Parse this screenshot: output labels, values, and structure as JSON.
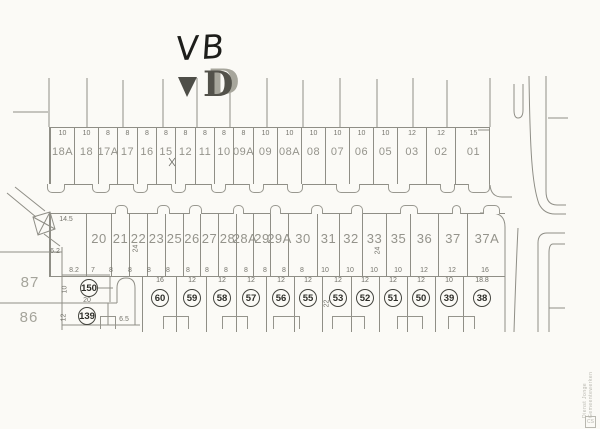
{
  "annotations": {
    "handwritten_label": "VB",
    "printed_fragment_letter": "D",
    "correction_mark_between_15_12": "x"
  },
  "watermark": {
    "text": "Dienst Jonge Gemeentewerken",
    "logo": "CS"
  },
  "north_row": {
    "box": {
      "x": 49,
      "y": 127,
      "w": 441,
      "h": 58
    },
    "lots": [
      {
        "num": "18A",
        "dim": "10",
        "x": 0,
        "w": 24
      },
      {
        "num": "18",
        "dim": "10",
        "x": 24,
        "w": 24
      },
      {
        "num": "17A",
        "dim": "8",
        "x": 48,
        "w": 19
      },
      {
        "num": "17",
        "dim": "8",
        "x": 67,
        "w": 20
      },
      {
        "num": "16",
        "dim": "8",
        "x": 87,
        "w": 19
      },
      {
        "num": "15",
        "dim": "8",
        "x": 106,
        "w": 19
      },
      {
        "num": "12",
        "dim": "8",
        "x": 125,
        "w": 20
      },
      {
        "num": "11",
        "dim": "8",
        "x": 145,
        "w": 19
      },
      {
        "num": "10",
        "dim": "8",
        "x": 164,
        "w": 19
      },
      {
        "num": "09A",
        "dim": "8",
        "x": 183,
        "w": 20
      },
      {
        "num": "09",
        "dim": "10",
        "x": 203,
        "w": 24
      },
      {
        "num": "08A",
        "dim": "10",
        "x": 227,
        "w": 24
      },
      {
        "num": "08",
        "dim": "10",
        "x": 251,
        "w": 24
      },
      {
        "num": "07",
        "dim": "10",
        "x": 275,
        "w": 24
      },
      {
        "num": "06",
        "dim": "10",
        "x": 299,
        "w": 24
      },
      {
        "num": "05",
        "dim": "10",
        "x": 323,
        "w": 24
      },
      {
        "num": "03",
        "dim": "12",
        "x": 347,
        "w": 29
      },
      {
        "num": "02",
        "dim": "12",
        "x": 376,
        "w": 29
      },
      {
        "num": "01",
        "dim": "15",
        "x": 405,
        "w": 36
      }
    ]
  },
  "middle_row": {
    "box": {
      "x": 49,
      "y": 213,
      "w": 456,
      "h": 64
    },
    "lots": [
      {
        "num": "",
        "x": 0,
        "w": 36
      },
      {
        "num": "20",
        "x": 36,
        "w": 25
      },
      {
        "num": "21",
        "x": 61,
        "w": 18
      },
      {
        "num": "22",
        "x": 79,
        "w": 18
      },
      {
        "num": "23",
        "x": 97,
        "w": 18
      },
      {
        "num": "25",
        "x": 115,
        "w": 18
      },
      {
        "num": "26",
        "x": 133,
        "w": 17
      },
      {
        "num": "27",
        "x": 150,
        "w": 18
      },
      {
        "num": "28",
        "x": 168,
        "w": 18
      },
      {
        "num": "28A",
        "x": 186,
        "w": 17
      },
      {
        "num": "29",
        "x": 203,
        "w": 17
      },
      {
        "num": "29A",
        "x": 220,
        "w": 18
      },
      {
        "num": "30",
        "x": 238,
        "w": 29
      },
      {
        "num": "31",
        "x": 267,
        "w": 22
      },
      {
        "num": "32",
        "x": 289,
        "w": 23
      },
      {
        "num": "33",
        "x": 312,
        "w": 24
      },
      {
        "num": "35",
        "x": 336,
        "w": 24
      },
      {
        "num": "36",
        "x": 360,
        "w": 28
      },
      {
        "num": "37",
        "x": 388,
        "w": 29
      },
      {
        "num": "37A",
        "x": 417,
        "w": 39
      }
    ]
  },
  "south_row": {
    "circles": [
      {
        "num": "60",
        "dim": "16",
        "cx": 160
      },
      {
        "num": "59",
        "dim": "12",
        "cx": 192
      },
      {
        "num": "58",
        "dim": "12",
        "cx": 222
      },
      {
        "num": "57",
        "dim": "12",
        "cx": 251
      },
      {
        "num": "56",
        "dim": "12",
        "cx": 281
      },
      {
        "num": "55",
        "dim": "12",
        "cx": 308
      },
      {
        "num": "53",
        "dim": "12",
        "cx": 338
      },
      {
        "num": "52",
        "dim": "12",
        "cx": 365
      },
      {
        "num": "51",
        "dim": "12",
        "cx": 393
      },
      {
        "num": "50",
        "dim": "12",
        "cx": 421
      },
      {
        "num": "39",
        "dim": "10",
        "cx": 449
      },
      {
        "num": "38",
        "dim": "18.8",
        "cx": 482
      }
    ],
    "separators": [
      142,
      176,
      206,
      236,
      266,
      294,
      322,
      351,
      379,
      407,
      435,
      463
    ]
  },
  "left_parcels": {
    "circle150": "150",
    "circle139": "139"
  },
  "tiny_labels": [
    {
      "t": "8.2",
      "x": 74,
      "y": 267
    },
    {
      "t": "7",
      "x": 93,
      "y": 267
    },
    {
      "t": "8",
      "x": 111,
      "y": 267
    },
    {
      "t": "8",
      "x": 130,
      "y": 267
    },
    {
      "t": "8",
      "x": 149,
      "y": 267
    },
    {
      "t": "8",
      "x": 168,
      "y": 267
    },
    {
      "t": "8",
      "x": 188,
      "y": 267
    },
    {
      "t": "8",
      "x": 207,
      "y": 267
    },
    {
      "t": "8",
      "x": 226,
      "y": 267
    },
    {
      "t": "8",
      "x": 246,
      "y": 267
    },
    {
      "t": "8",
      "x": 265,
      "y": 267
    },
    {
      "t": "8",
      "x": 284,
      "y": 267
    },
    {
      "t": "8",
      "x": 302,
      "y": 267
    },
    {
      "t": "10",
      "x": 325,
      "y": 267
    },
    {
      "t": "10",
      "x": 350,
      "y": 267
    },
    {
      "t": "10",
      "x": 374,
      "y": 267
    },
    {
      "t": "10",
      "x": 398,
      "y": 267
    },
    {
      "t": "12",
      "x": 424,
      "y": 267
    },
    {
      "t": "12",
      "x": 452,
      "y": 267
    },
    {
      "t": "16",
      "x": 485,
      "y": 267
    },
    {
      "t": "14.5",
      "x": 66,
      "y": 216
    },
    {
      "t": "6.2",
      "x": 55,
      "y": 248
    },
    {
      "t": "20",
      "x": 87,
      "y": 297
    },
    {
      "t": "6.5",
      "x": 124,
      "y": 316
    },
    {
      "t": "10",
      "x": 65,
      "y": 286,
      "r": 1
    },
    {
      "t": "12",
      "x": 64,
      "y": 314,
      "r": 1
    },
    {
      "t": "22",
      "x": 327,
      "y": 300,
      "r": 1
    },
    {
      "t": "24",
      "x": 378,
      "y": 247,
      "r": 1
    },
    {
      "t": "24",
      "x": 136,
      "y": 245,
      "r": 1
    }
  ],
  "big_labels": [
    {
      "t": "87",
      "x": 30,
      "y": 274
    },
    {
      "t": "86",
      "x": 29,
      "y": 309
    }
  ],
  "bumps_down": [
    {
      "x": 47,
      "w": 18
    },
    {
      "x": 92,
      "w": 18
    },
    {
      "x": 133,
      "w": 15
    },
    {
      "x": 171,
      "w": 15
    },
    {
      "x": 211,
      "w": 15
    },
    {
      "x": 249,
      "w": 15
    },
    {
      "x": 287,
      "w": 16
    },
    {
      "x": 336,
      "w": 24
    },
    {
      "x": 388,
      "w": 22
    },
    {
      "x": 440,
      "w": 15
    },
    {
      "x": 468,
      "w": 22
    }
  ],
  "bumps_up": [
    {
      "x": 115,
      "w": 13
    },
    {
      "x": 157,
      "w": 13
    },
    {
      "x": 189,
      "w": 13
    },
    {
      "x": 233,
      "w": 11
    },
    {
      "x": 270,
      "w": 11
    },
    {
      "x": 311,
      "w": 12
    },
    {
      "x": 351,
      "w": 12
    },
    {
      "x": 400,
      "w": 18
    },
    {
      "x": 452,
      "w": 9
    },
    {
      "x": 483,
      "w": 17
    }
  ],
  "footprints": [
    {
      "x": 163,
      "w": 26
    },
    {
      "x": 222,
      "w": 26
    },
    {
      "x": 273,
      "w": 27
    },
    {
      "x": 332,
      "w": 33
    },
    {
      "x": 397,
      "w": 26
    },
    {
      "x": 448,
      "w": 27
    },
    {
      "x": 100,
      "w": 16
    }
  ],
  "linework": {
    "stroke": "#8f8e86",
    "paths": [
      {
        "n": "lot-extension-line",
        "d": "M49,78V127"
      },
      {
        "n": "lot-extension-line",
        "d": "M87,78V127"
      },
      {
        "n": "lot-extension-line",
        "d": "M123,80V127"
      },
      {
        "n": "lot-extension-line",
        "d": "M163,79V127"
      },
      {
        "n": "lot-extension-line",
        "d": "M197,78V127"
      },
      {
        "n": "lot-extension-line",
        "d": "M230,79V127"
      },
      {
        "n": "lot-extension-line",
        "d": "M267,78V127"
      },
      {
        "n": "lot-extension-line",
        "d": "M303,80V127"
      },
      {
        "n": "lot-extension-line",
        "d": "M340,78V127"
      },
      {
        "n": "lot-extension-line",
        "d": "M377,79V127"
      },
      {
        "n": "lot-extension-line",
        "d": "M413,78V127"
      },
      {
        "n": "lot-extension-line",
        "d": "M447,80V127"
      },
      {
        "n": "lot-extension-line",
        "d": "M490,78V127"
      },
      {
        "n": "boundary-tick",
        "d": "M13,112H48"
      },
      {
        "n": "diagonal-road",
        "d": "M7,193L36,217"
      },
      {
        "n": "diagonal-road",
        "d": "M15,187L45,211"
      },
      {
        "n": "small-building",
        "d": "M33,217L50,212L55,229L38,235Z"
      },
      {
        "n": "small-building-hatch",
        "d": "M33,217L55,229"
      },
      {
        "n": "small-building-hatch",
        "d": "M50,212L38,235"
      },
      {
        "n": "boundary-tick",
        "d": "M44,234L60,246"
      },
      {
        "n": "left-lot-line",
        "d": "M0,252H62"
      },
      {
        "n": "left-lot-line",
        "d": "M0,303H117"
      },
      {
        "n": "left-lot-line",
        "d": "M62,247V330"
      },
      {
        "n": "lot150-line",
        "d": "M62,275H110"
      },
      {
        "n": "lot150-line",
        "d": "M110,276V302"
      },
      {
        "n": "lot139-line",
        "d": "M108,303V325"
      },
      {
        "n": "lot139-line",
        "d": "M62,325H140"
      },
      {
        "n": "lot150-tick",
        "d": "M97,288H113"
      },
      {
        "n": "cul-de-sac-lane",
        "d": "M117,303V288Q117,278 126,278Q135,278 135,288V325"
      },
      {
        "n": "street-line",
        "d": "M529,76C530,150 532,185 539,204Q544,214 555,214H566"
      },
      {
        "n": "street-line",
        "d": "M546,76V191Q546,205 557,205H566"
      },
      {
        "n": "street-tick",
        "d": "M548,118H568"
      },
      {
        "n": "street-island",
        "d": "M514,84V110Q514,118 518,118Q523,118 523,110V84"
      },
      {
        "n": "street-tick",
        "d": "M478,130H490"
      },
      {
        "n": "street-corner",
        "d": "M490,185Q491,197 502,197H512"
      },
      {
        "n": "block-corner",
        "d": "M480,213H491Q505,213 505,227V332"
      },
      {
        "n": "street-line",
        "d": "M518,228C516,268 515,300 514,332"
      },
      {
        "n": "block-corner",
        "d": "M565,233H547Q538,233 538,243V332"
      },
      {
        "n": "block-corner",
        "d": "M565,244H553Q549,244 549,253V332"
      },
      {
        "n": "street-tick",
        "d": "M549,308H565"
      }
    ],
    "marks": [
      {
        "n": "handwritten-correction",
        "d": "M169,158l6,8M175,158l-6,8"
      }
    ],
    "printed_v_fragment": "M178,77L197,77L187,97Z"
  }
}
